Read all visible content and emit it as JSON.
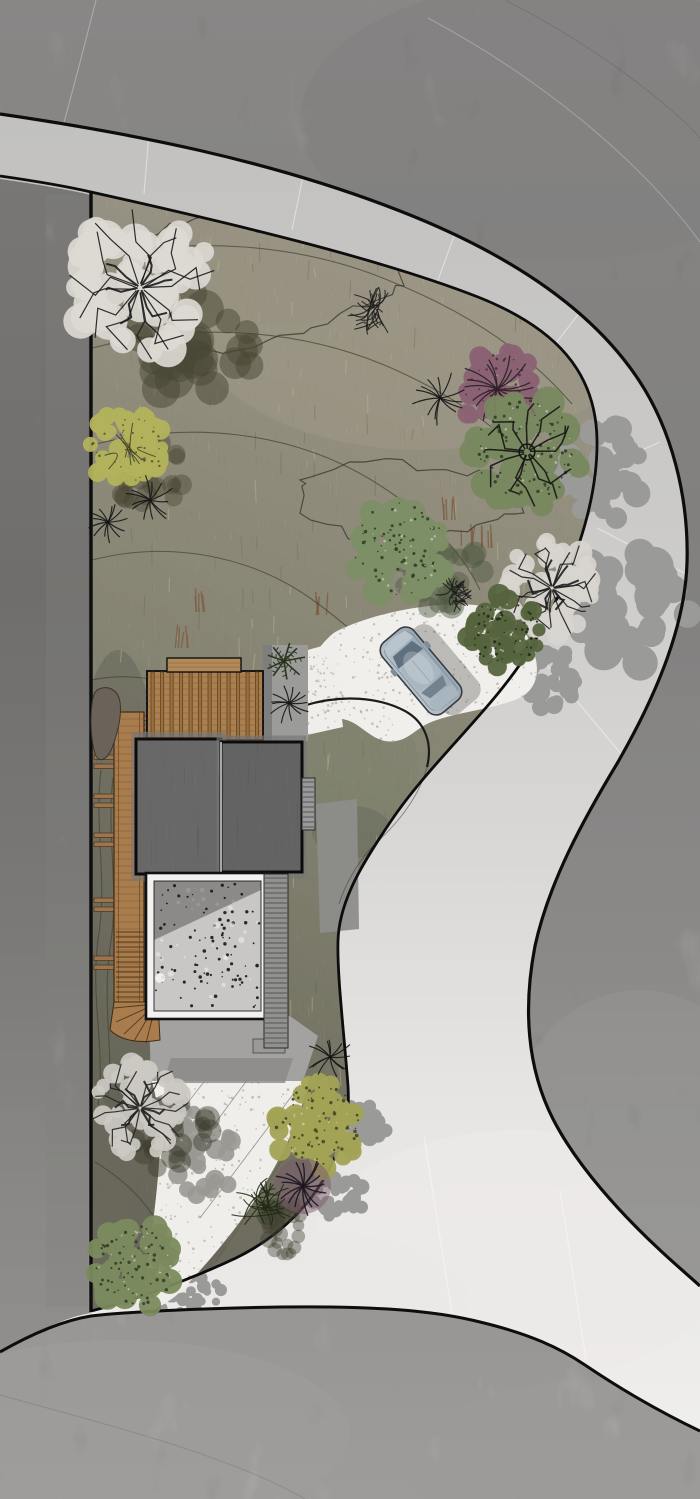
{
  "meta": {
    "title": "Residential landscape site plan rendering",
    "view": "top-down architectural plan",
    "visible_text": "none"
  },
  "scene": {
    "w": 700,
    "h": 1499,
    "background": {
      "grad": [
        [
          "0",
          "#979593"
        ],
        [
          "0.35",
          "#8d8b89"
        ],
        [
          "0.62",
          "#9a9896"
        ],
        [
          "0.85",
          "#acaaa8"
        ],
        [
          "1",
          "#b5b3b1"
        ]
      ],
      "light_patches": [
        {
          "cx": 640,
          "cy": 1160,
          "rx": 140,
          "ry": 170,
          "fill": "#b0aeac",
          "op": 0.4
        },
        {
          "cx": 120,
          "cy": 1435,
          "rx": 230,
          "ry": 95,
          "fill": "#b8b6b4",
          "op": 0.5
        },
        {
          "cx": 600,
          "cy": 1465,
          "rx": 190,
          "ry": 85,
          "fill": "#b4b2b0",
          "op": 0.4
        },
        {
          "cx": 560,
          "cy": 120,
          "rx": 260,
          "ry": 140,
          "fill": "#8a8886",
          "op": 0.35
        }
      ],
      "faint_lines": [
        {
          "d": "M 96,0 C 72,95 42,205 10,318",
          "c": "#ffffff",
          "op": 0.3
        },
        {
          "d": "M 428,18 C 540,78 638,158 700,242",
          "c": "#ffffff",
          "op": 0.25
        },
        {
          "d": "M 505,0 C 600,48 676,110 700,138",
          "c": "#000000",
          "op": 0.1
        },
        {
          "d": "M 28,1075 C 58,1120 66,1178 46,1240",
          "c": "#000000",
          "op": 0.12
        },
        {
          "d": "M 590,1320 C 640,1352 672,1382 695,1412",
          "c": "#ffffff",
          "op": 0.3
        },
        {
          "d": "M 0,1395 C 120,1428 235,1458 305,1499",
          "c": "#000000",
          "op": 0.1
        }
      ]
    },
    "road": {
      "fill_path": "M 0,114 C 130,133 270,160 400,211 C 505,252 588,306 636,376 C 672,428 689,498 687,563 C 685,625 658,692 618,762 C 583,820 549,882 535,946 C 523,1008 527,1068 553,1119 C 577,1166 621,1214 662,1252 C 676,1265 689,1276 700,1286 L 700,1431 C 660,1412 625,1392 585,1365 C 560,1348 530,1334 480,1322 C 440,1312 395,1308 330,1307 C 250,1306 135,1311 91,1316 C 60,1321 28,1336 0,1352 Z",
      "grad": [
        [
          "0",
          "#c2c1bf"
        ],
        [
          "0.3",
          "#cbcac8"
        ],
        [
          "0.55",
          "#d8d7d5"
        ],
        [
          "0.75",
          "#e6e5e3"
        ],
        [
          "1",
          "#efeeec"
        ]
      ],
      "outer_edge": "M 0,114 C 130,133 270,160 400,211 C 505,252 588,306 636,376 C 672,428 689,498 687,563 C 685,625 658,692 618,762 C 583,820 549,882 535,946 C 523,1008 527,1068 553,1119 C 577,1166 621,1214 662,1252 C 676,1265 689,1276 700,1286",
      "inner_edge": "M 0,176 C 35,181 65,186 91,192 C 230,223 378,258 478,297 C 556,328 596,372 597,440 C 598,505 571,579 533,644 C 497,706 432,760 391,821 C 364,861 339,900 338,941 C 337,976 344,1032 348,1086 C 350,1121 344,1141 332,1163 C 315,1201 281,1236 236,1258 C 187,1281 131,1301 91,1311",
      "south_edge": "M 700,1431 C 660,1412 625,1392 585,1365 C 560,1348 530,1334 480,1322 C 440,1312 395,1308 330,1307 C 250,1306 135,1311 91,1316 C 60,1321 28,1336 0,1352",
      "junction_wash": [
        {
          "cx": 520,
          "cy": 1255,
          "rx": 210,
          "ry": 125,
          "fill": "#eceae8",
          "op": 0.75
        },
        {
          "cx": 300,
          "cy": 1300,
          "rx": 170,
          "ry": 70,
          "fill": "#eae8e6",
          "op": 0.6
        }
      ],
      "seams": [
        [
          150,
          121,
          144,
          194
        ],
        [
          305,
          166,
          292,
          230
        ],
        [
          455,
          233,
          432,
          297
        ],
        [
          580,
          312,
          540,
          364
        ],
        [
          660,
          442,
          598,
          470
        ],
        [
          688,
          575,
          597,
          528
        ],
        [
          622,
          755,
          536,
          652
        ],
        [
          424,
          1136,
          452,
          1314
        ],
        [
          560,
          1190,
          586,
          1360
        ]
      ],
      "edge_color": "#0d0d0d"
    },
    "left_strip": {
      "patch": "M 0,179 C 35,184 65,189 91,195 L 91,1313 C 60,1318 28,1337 0,1353 Z",
      "band": {
        "x": 46,
        "y": 195,
        "w": 42,
        "h": 1112,
        "fill": "#a3a19f",
        "op": 0.3
      }
    },
    "parcel": {
      "path": "M 91,192 C 230,223 378,258 478,297 C 556,328 596,372 597,440 C 598,505 571,579 533,644 C 497,706 432,760 391,821 C 364,861 339,900 338,941 C 337,976 344,1032 348,1086 C 350,1121 344,1141 332,1163 C 315,1201 281,1236 236,1258 C 187,1281 131,1301 91,1311 Z",
      "grad": [
        [
          "0",
          "#b8ad93"
        ],
        [
          "0.28",
          "#a59d7f"
        ],
        [
          "0.55",
          "#8d8a6a"
        ],
        [
          "0.8",
          "#727053"
        ],
        [
          "1",
          "#646147"
        ]
      ],
      "grad_line": {
        "x1": 560,
        "y1": 230,
        "x2": 110,
        "y2": 1200
      },
      "shade": [
        {
          "cx": 420,
          "cy": 300,
          "rx": 240,
          "ry": 150,
          "fill": "#c2b694",
          "op": 0.45
        },
        {
          "cx": 280,
          "cy": 255,
          "rx": 120,
          "ry": 70,
          "fill": "#ad9f83",
          "op": 0.4
        },
        {
          "cx": 118,
          "cy": 880,
          "rx": 50,
          "ry": 230,
          "fill": "#3f3e2c",
          "op": 0.4
        },
        {
          "cx": 150,
          "cy": 1180,
          "rx": 90,
          "ry": 120,
          "fill": "#4a4936",
          "op": 0.35
        },
        {
          "cx": 360,
          "cy": 770,
          "rx": 58,
          "ry": 80,
          "fill": "#7e8960",
          "op": 0.45
        },
        {
          "cx": 352,
          "cy": 832,
          "rx": 40,
          "ry": 26,
          "fill": "#434a33",
          "op": 0.35
        }
      ],
      "contours": [
        "M 92,258 C 190,236 300,243 390,281 C 470,313 530,355 572,404",
        "M 92,348 C 200,320 310,330 400,372 C 470,404 520,444 552,492",
        "M 92,445 C 190,420 290,432 368,478 C 425,512 462,552 480,590",
        "M 92,560 C 170,540 250,556 310,598 C 355,630 385,660 398,684",
        "M 92,680 C 140,670 190,684 228,712",
        "M 95,1162 C 125,1180 150,1205 162,1232",
        "M 101,770 C 94,830 108,880 98,940 C 90,1000 106,1050 98,1105",
        "M 113,778 C 106,838 120,888 110,948 C 102,1006 114,1050 108,1096"
      ],
      "zones": [
        {
          "amp": 6,
          "pts": [
            [
              105,
              302
            ],
            [
              128,
              252
            ],
            [
              168,
              226
            ],
            [
              214,
              218
            ],
            [
              258,
              228
            ],
            [
              300,
              222
            ],
            [
              344,
              232
            ],
            [
              388,
              252
            ],
            [
              408,
              282
            ],
            [
              380,
              302
            ],
            [
              338,
              312
            ],
            [
              298,
              330
            ],
            [
              254,
              344
            ],
            [
              205,
              350
            ],
            [
              160,
              340
            ],
            [
              124,
              324
            ]
          ]
        },
        {
          "amp": 6,
          "pts": [
            [
              300,
              480
            ],
            [
              348,
              462
            ],
            [
              398,
              465
            ],
            [
              448,
              472
            ],
            [
              498,
              478
            ],
            [
              526,
              494
            ],
            [
              518,
              514
            ],
            [
              480,
              528
            ],
            [
              430,
              536
            ],
            [
              380,
              540
            ],
            [
              336,
              532
            ],
            [
              306,
              512
            ]
          ]
        }
      ],
      "reeds": [
        [
          450,
          520
        ],
        [
          466,
          546
        ],
        [
          198,
          612
        ],
        [
          182,
          648
        ],
        [
          320,
          615
        ],
        [
          488,
          548
        ]
      ],
      "contour_color": "#45442f",
      "boundary_color": "#0d0d0d"
    },
    "driveway": {
      "path": "M 337,631 C 382,609 458,597 496,609 C 519,616 531,638 536,660 C 540,681 531,695 512,701 C 482,711 452,713 429,723 C 416,729 409,739 396,741 C 379,744 369,733 357,725 C 341,714 321,718 306,724 C 291,729 282,719 280,706 C 278,691 285,678 299,669 C 312,660 325,637 337,631 Z",
      "fill": "#f0efeb",
      "speckle": "#b7b1a7",
      "island_arc": "M 303,706 C 341,694 379,697 405,711 C 425,722 433,743 427,767",
      "island_edge": "M 427,767 C 419,797 398,823 376,843 C 359,860 346,882 339,904"
    },
    "lower_path": {
      "path": "M 151,1078 L 309,1078 C 302,1116 281,1161 251,1206 C 230,1237 205,1266 179,1293 C 168,1303 156,1309 146,1312 C 143,1300 146,1282 148,1262 C 154,1216 160,1170 160,1138 C 160,1116 156,1096 151,1078 Z",
      "fill": "#efeeea",
      "joints": [
        [
          232,
          1046,
          168,
          1128
        ],
        [
          268,
          1052,
          182,
          1168
        ],
        [
          300,
          1085,
          200,
          1218
        ],
        [
          294,
          1142,
          216,
          1262
        ]
      ]
    },
    "upper_path": {
      "path": "M 304,651 L 333,643 L 343,727 L 307,735 Z",
      "fill": "#efeeea"
    },
    "pads": {
      "east_pad": {
        "x": 263,
        "y": 645,
        "w": 45,
        "h": 96,
        "fill": "#9b9b99"
      },
      "south_pad": {
        "path": "M 149,1016 L 290,1016 L 318,1036 L 303,1081 L 151,1081 Z",
        "fill": "#a3a2a0",
        "band": "M 171,1058 L 293,1058 L 285,1083 L 163,1083 Z",
        "band_fill": "#8b8a88",
        "sq": {
          "x": 253,
          "y": 1039,
          "w": 32,
          "h": 14,
          "fill": "#9a9998",
          "stroke": "#555555"
        }
      }
    },
    "house": {
      "deck": {
        "x": 147,
        "y": 671,
        "w": 116,
        "h": 69,
        "fill": "#aa8050",
        "slat": "#97703f",
        "slat_edge": "#5a3c1c",
        "plank": "#7b5631",
        "outline": "#161616"
      },
      "step": {
        "x": 167,
        "y": 658,
        "w": 74,
        "h": 14,
        "fill": "#b28a58"
      },
      "roof_left": {
        "x": 136,
        "y": 739,
        "w": 85,
        "h": 135
      },
      "roof_right": {
        "x": 221,
        "y": 742,
        "w": 81,
        "h": 130
      },
      "roof_fill": "#48484a",
      "roof_outline": "#0c0c0c",
      "ridge": "#b9b9b9",
      "courtyard": {
        "x": 146,
        "y": 873,
        "w": 123,
        "h": 146,
        "frame": "#f2f1ef",
        "inner": "#c8c7c5",
        "dot": "#161616",
        "light_dot": "#f0efed",
        "shadow": "M 154,881 L 261,881 L 261,890 L 154,940 Z"
      },
      "stairs_east": {
        "x": 264,
        "y": 874,
        "w": 24,
        "h": 174,
        "fill": "#919190",
        "tread": "#4c4c4c"
      },
      "stairs_ne": {
        "x": 302,
        "y": 778,
        "w": 13,
        "h": 52,
        "fill": "#99999a",
        "tread": "#4c4c4c"
      },
      "boardwalk": {
        "x": 114,
        "y": 712,
        "w": 30,
        "h": 292,
        "fill": "#a87c4c",
        "edge": "#3f2c14",
        "plank": "#7a5530",
        "tie_fill": "#9c7450",
        "tie_edge": "#4a3318",
        "tie_ys": [
          716,
          755,
          794,
          833,
          898,
          956
        ],
        "steps_from": 932,
        "fan": "M 114,1002 L 158,1002 L 160,1040 C 138,1044 120,1040 110,1030 Z",
        "fan_pivot": [
          156,
          1004
        ],
        "fan_tips": [
          [
            114,
            1008
          ],
          [
            116,
            1022
          ],
          [
            124,
            1034
          ],
          [
            134,
            1041
          ],
          [
            146,
            1043
          ]
        ]
      },
      "boulder": {
        "path": "M 97,690 C 108,684 118,690 120,702 C 122,716 118,732 112,748 C 107,760 99,764 95,754 C 91,740 90,720 92,704 C 93,696 94,693 97,690 Z",
        "fill": "#6b6359",
        "stroke": "#3a352e"
      },
      "shadow_east": "M 316,804 L 357,799 L 359,929 L 320,933 Z",
      "shadow_color": "#8d8d8b"
    },
    "car": {
      "cx": 421,
      "cy": 671,
      "angle": -40,
      "body": "#b7c1c9",
      "body2": "#98a7b2",
      "roof": "#a9b5bf",
      "glass": "#5f707e",
      "glass2": "#72828f",
      "hood": "#bac4cc",
      "outline": "#383e44",
      "trim": "#7f8d98"
    },
    "road_shadows": [
      {
        "x": 605,
        "y": 473,
        "rx": 42,
        "ry": 52
      },
      {
        "x": 628,
        "y": 610,
        "rx": 60,
        "ry": 58
      },
      {
        "x": 548,
        "y": 680,
        "rx": 30,
        "ry": 34
      },
      {
        "x": 360,
        "y": 1128,
        "rx": 26,
        "ry": 24
      },
      {
        "x": 338,
        "y": 1196,
        "rx": 27,
        "ry": 23
      },
      {
        "x": 183,
        "y": 1292,
        "rx": 40,
        "ry": 21
      }
    ],
    "road_shadow_color": "#9a9a98",
    "vegetation": [
      {
        "name": "large-bare-tree",
        "type": "sketch",
        "x": 140,
        "y": 288,
        "r": 74,
        "fluff": "#dcd9d2",
        "branch": "#1a1a1a",
        "seed": 11,
        "shadow": {
          "dx": 58,
          "dy": 58,
          "color": "#474633",
          "op": 0.5
        }
      },
      {
        "name": "yellow-green-tree",
        "type": "scribble",
        "x": 128,
        "y": 447,
        "r": 41,
        "fill": "#b2b25c",
        "line": "#3e3e20",
        "seed": 21,
        "shadow": {
          "dx": 22,
          "dy": 26,
          "color": "#474633",
          "op": 0.42
        }
      },
      {
        "name": "purple-tree",
        "type": "purple",
        "x": 497,
        "y": 389,
        "r": 40,
        "fill": "#8a6273",
        "line": "#2d1f28",
        "seed": 31
      },
      {
        "name": "green-radial-tree",
        "type": "leaf",
        "x": 527,
        "y": 452,
        "r": 56,
        "fill": "#78885f",
        "dot": "#2e3b23",
        "branches": true,
        "seed": 41
      },
      {
        "name": "leafy-bush",
        "type": "leaf",
        "x": 399,
        "y": 549,
        "r": 50,
        "fill": "#7d8f66",
        "dot": "#2e3b23",
        "branches": false,
        "seed": 51,
        "shadow": {
          "dx": 42,
          "dy": 22,
          "color": "#4d5840",
          "op": 0.45
        }
      },
      {
        "name": "gray-bare-tree",
        "type": "sketch",
        "x": 552,
        "y": 588,
        "r": 48,
        "fluff": "#d8d5cf",
        "branch": "#1e1e1e",
        "seed": 61
      },
      {
        "name": "dark-sketch-shrub",
        "type": "shrubSketch",
        "x": 374,
        "y": 310,
        "r": 30,
        "color": "#1c1c1c",
        "seed": 71
      },
      {
        "name": "yucca-plant",
        "type": "spiky",
        "x": 440,
        "y": 398,
        "r": 27,
        "seed": 81
      },
      {
        "name": "yucca-plant-2",
        "type": "spiky",
        "x": 150,
        "y": 500,
        "r": 25,
        "seed": 91
      },
      {
        "name": "yucca-plant-3",
        "type": "spiky",
        "x": 108,
        "y": 522,
        "r": 20,
        "seed": 101
      },
      {
        "name": "dense-green-shrub",
        "type": "bush",
        "x": 505,
        "y": 632,
        "r": 38,
        "fill": "#55643e",
        "seed": 111
      },
      {
        "name": "small-sketch-shrub",
        "type": "shrubSketch",
        "x": 455,
        "y": 595,
        "r": 22,
        "color": "#1c1c1c",
        "seed": 121
      },
      {
        "name": "gray-bare-tree-south",
        "type": "sketch",
        "x": 140,
        "y": 1108,
        "r": 46,
        "fluff": "#ccc9c2",
        "branch": "#222222",
        "seed": 131,
        "shadow": {
          "dx": 30,
          "dy": 27,
          "color": "#3c3c2e",
          "op": 0.45
        }
      },
      {
        "name": "yellow-green-bush",
        "type": "leaf",
        "x": 317,
        "y": 1124,
        "r": 45,
        "fill": "#a2a355",
        "dot": "#3d4420",
        "branches": false,
        "seed": 141
      },
      {
        "name": "purple-spiky-plant",
        "type": "purpleSpiky",
        "x": 303,
        "y": 1186,
        "r": 28,
        "seed": 151
      },
      {
        "name": "green-sketch-shrub",
        "type": "shrubSketch",
        "x": 263,
        "y": 1206,
        "r": 33,
        "color": "#1f2a14",
        "seed": 161,
        "shadow": {
          "dx": 22,
          "dy": 22,
          "color": "#3c3c2e",
          "op": 0.4
        }
      },
      {
        "name": "green-bush-south",
        "type": "leaf",
        "x": 136,
        "y": 1266,
        "r": 44,
        "fill": "#7b8a5e",
        "dot": "#2e3b23",
        "branches": false,
        "seed": 171
      },
      {
        "name": "yucca-plant-4",
        "type": "spiky",
        "x": 330,
        "y": 1057,
        "r": 22,
        "seed": 181
      },
      {
        "name": "fern-plant",
        "type": "fern",
        "x": 284,
        "y": 661,
        "r": 21,
        "seed": 191
      },
      {
        "name": "agave-plant",
        "type": "spiky",
        "x": 289,
        "y": 703,
        "r": 21,
        "seed": 201
      }
    ]
  }
}
